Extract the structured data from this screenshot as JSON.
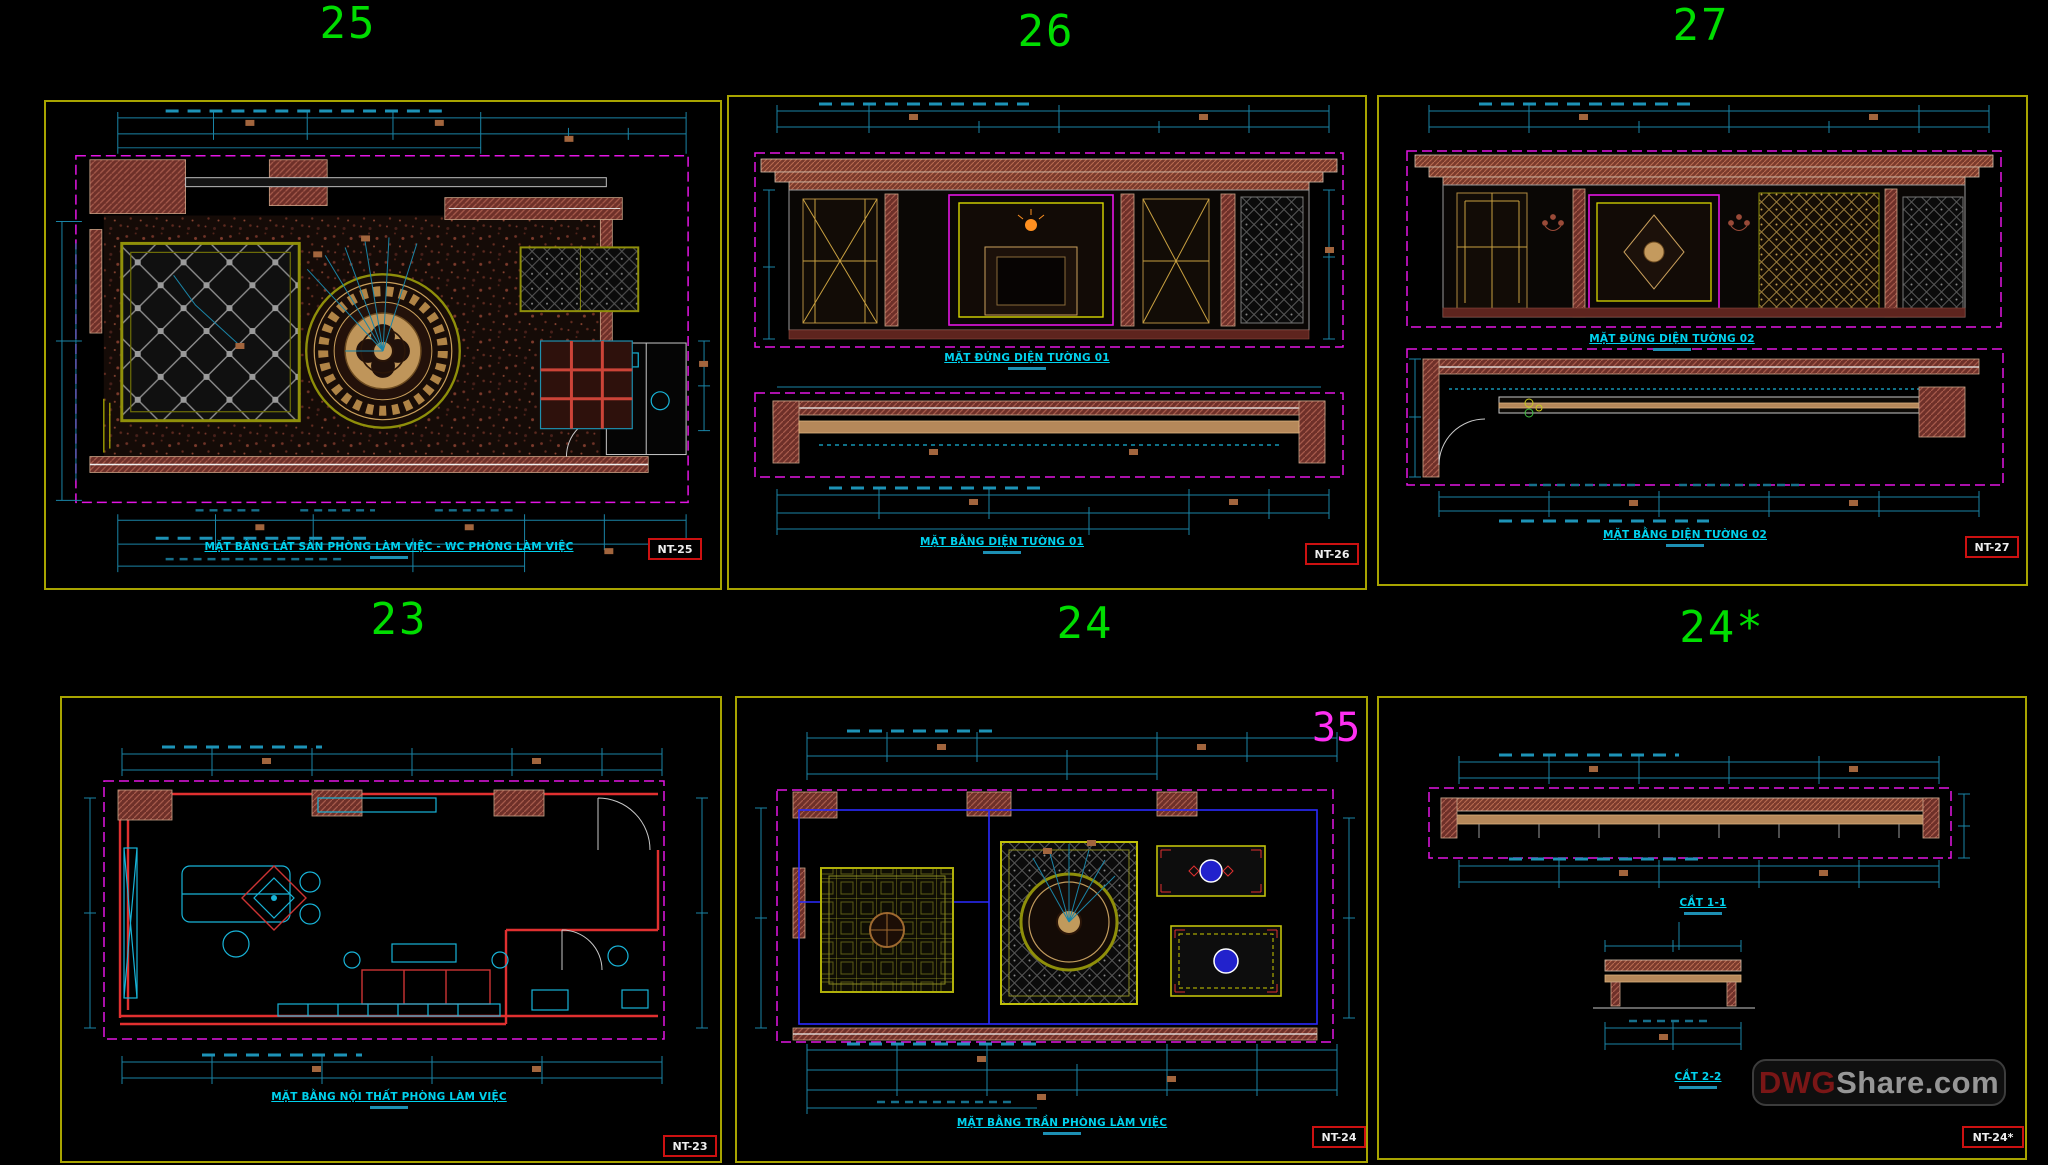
{
  "app": {
    "type": "CAD drawing sheet preview",
    "background": "#000000"
  },
  "watermark": {
    "prefix": "DWG",
    "suffix": "Share.com",
    "prefix_color": "#7a1616",
    "suffix_color": "#969696"
  },
  "colors": {
    "viewport_frame_yellow": "#a8a400",
    "sheet_number_green": "#00dd00",
    "dimension_cyan": "#1a84a6",
    "title_cyan": "#00d2ee",
    "boundary_magenta": "#e315e3",
    "wall_hatch_brown": "#6e3029",
    "sheet_box_red": "#cc1111",
    "annotation_magenta": "#ff2ff2",
    "furniture_red": "#e03030",
    "ceiling_blue": "#2a2aff",
    "wood_tan": "#b5885a"
  },
  "panels": [
    {
      "number": "25",
      "sheet_label": "NT-25",
      "titles": [
        "MẶT BẰNG LÁT SÀN PHÒNG LÀM VIỆC - WC PHÒNG LÀM VIỆC"
      ]
    },
    {
      "number": "26",
      "sheet_label": "NT-26",
      "titles": [
        "MẶT ĐỨNG DIỆN TƯỜNG 01",
        "MẶT BẰNG DIỆN TƯỜNG 01"
      ]
    },
    {
      "number": "27",
      "sheet_label": "NT-27",
      "titles": [
        "MẶT ĐỨNG DIỆN TƯỜNG 02",
        "MẶT BẰNG DIỆN TƯỜNG 02"
      ]
    },
    {
      "number": "23",
      "sheet_label": "NT-23",
      "titles": [
        "MẶT BẰNG NỘI THẤT PHÒNG LÀM VIỆC"
      ]
    },
    {
      "number": "24",
      "sheet_label": "NT-24",
      "annotation": "35",
      "titles": [
        "MẶT BẰNG TRẦN PHÒNG LÀM VIỆC"
      ]
    },
    {
      "number": "24*",
      "sheet_label": "NT-24*",
      "titles": [
        "CẮT 1-1",
        "CẮT 2-2"
      ]
    }
  ]
}
